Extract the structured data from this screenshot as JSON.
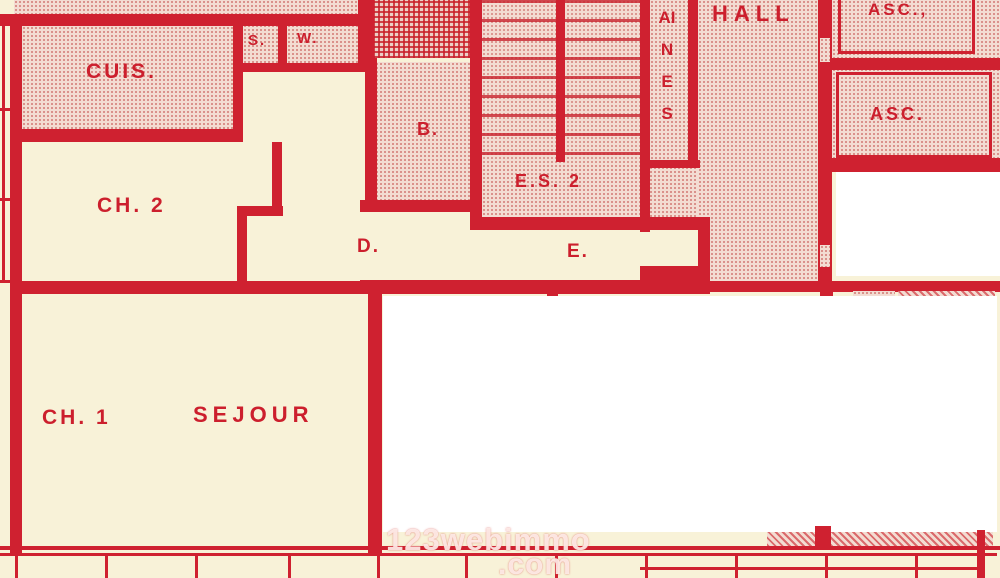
{
  "plan_title": "apartment-floor-plan",
  "rooms": {
    "cuisine": "CUIS.",
    "closet_s": "S.",
    "wc": "W.",
    "bath": "B.",
    "bedroom2": "CH. 2",
    "bedroom1": "CH. 1",
    "living": "SEJOUR",
    "corridor_d": "D.",
    "corridor_e": "E.",
    "stair_lobby": "E.S. 2",
    "hall": "HALL",
    "elevator1": "ASC.,",
    "elevator2": "ASC.",
    "shaft_vertical": "AINES"
  },
  "watermark": {
    "line1": "123webimmo",
    "line2": ".com"
  },
  "colors": {
    "wall_red": "#cf2130",
    "label_red": "#cc1f2d",
    "paper_cream": "#f8f2d8",
    "stipple_pink": "#f3dcd2",
    "mask_white": "#ffffff"
  }
}
